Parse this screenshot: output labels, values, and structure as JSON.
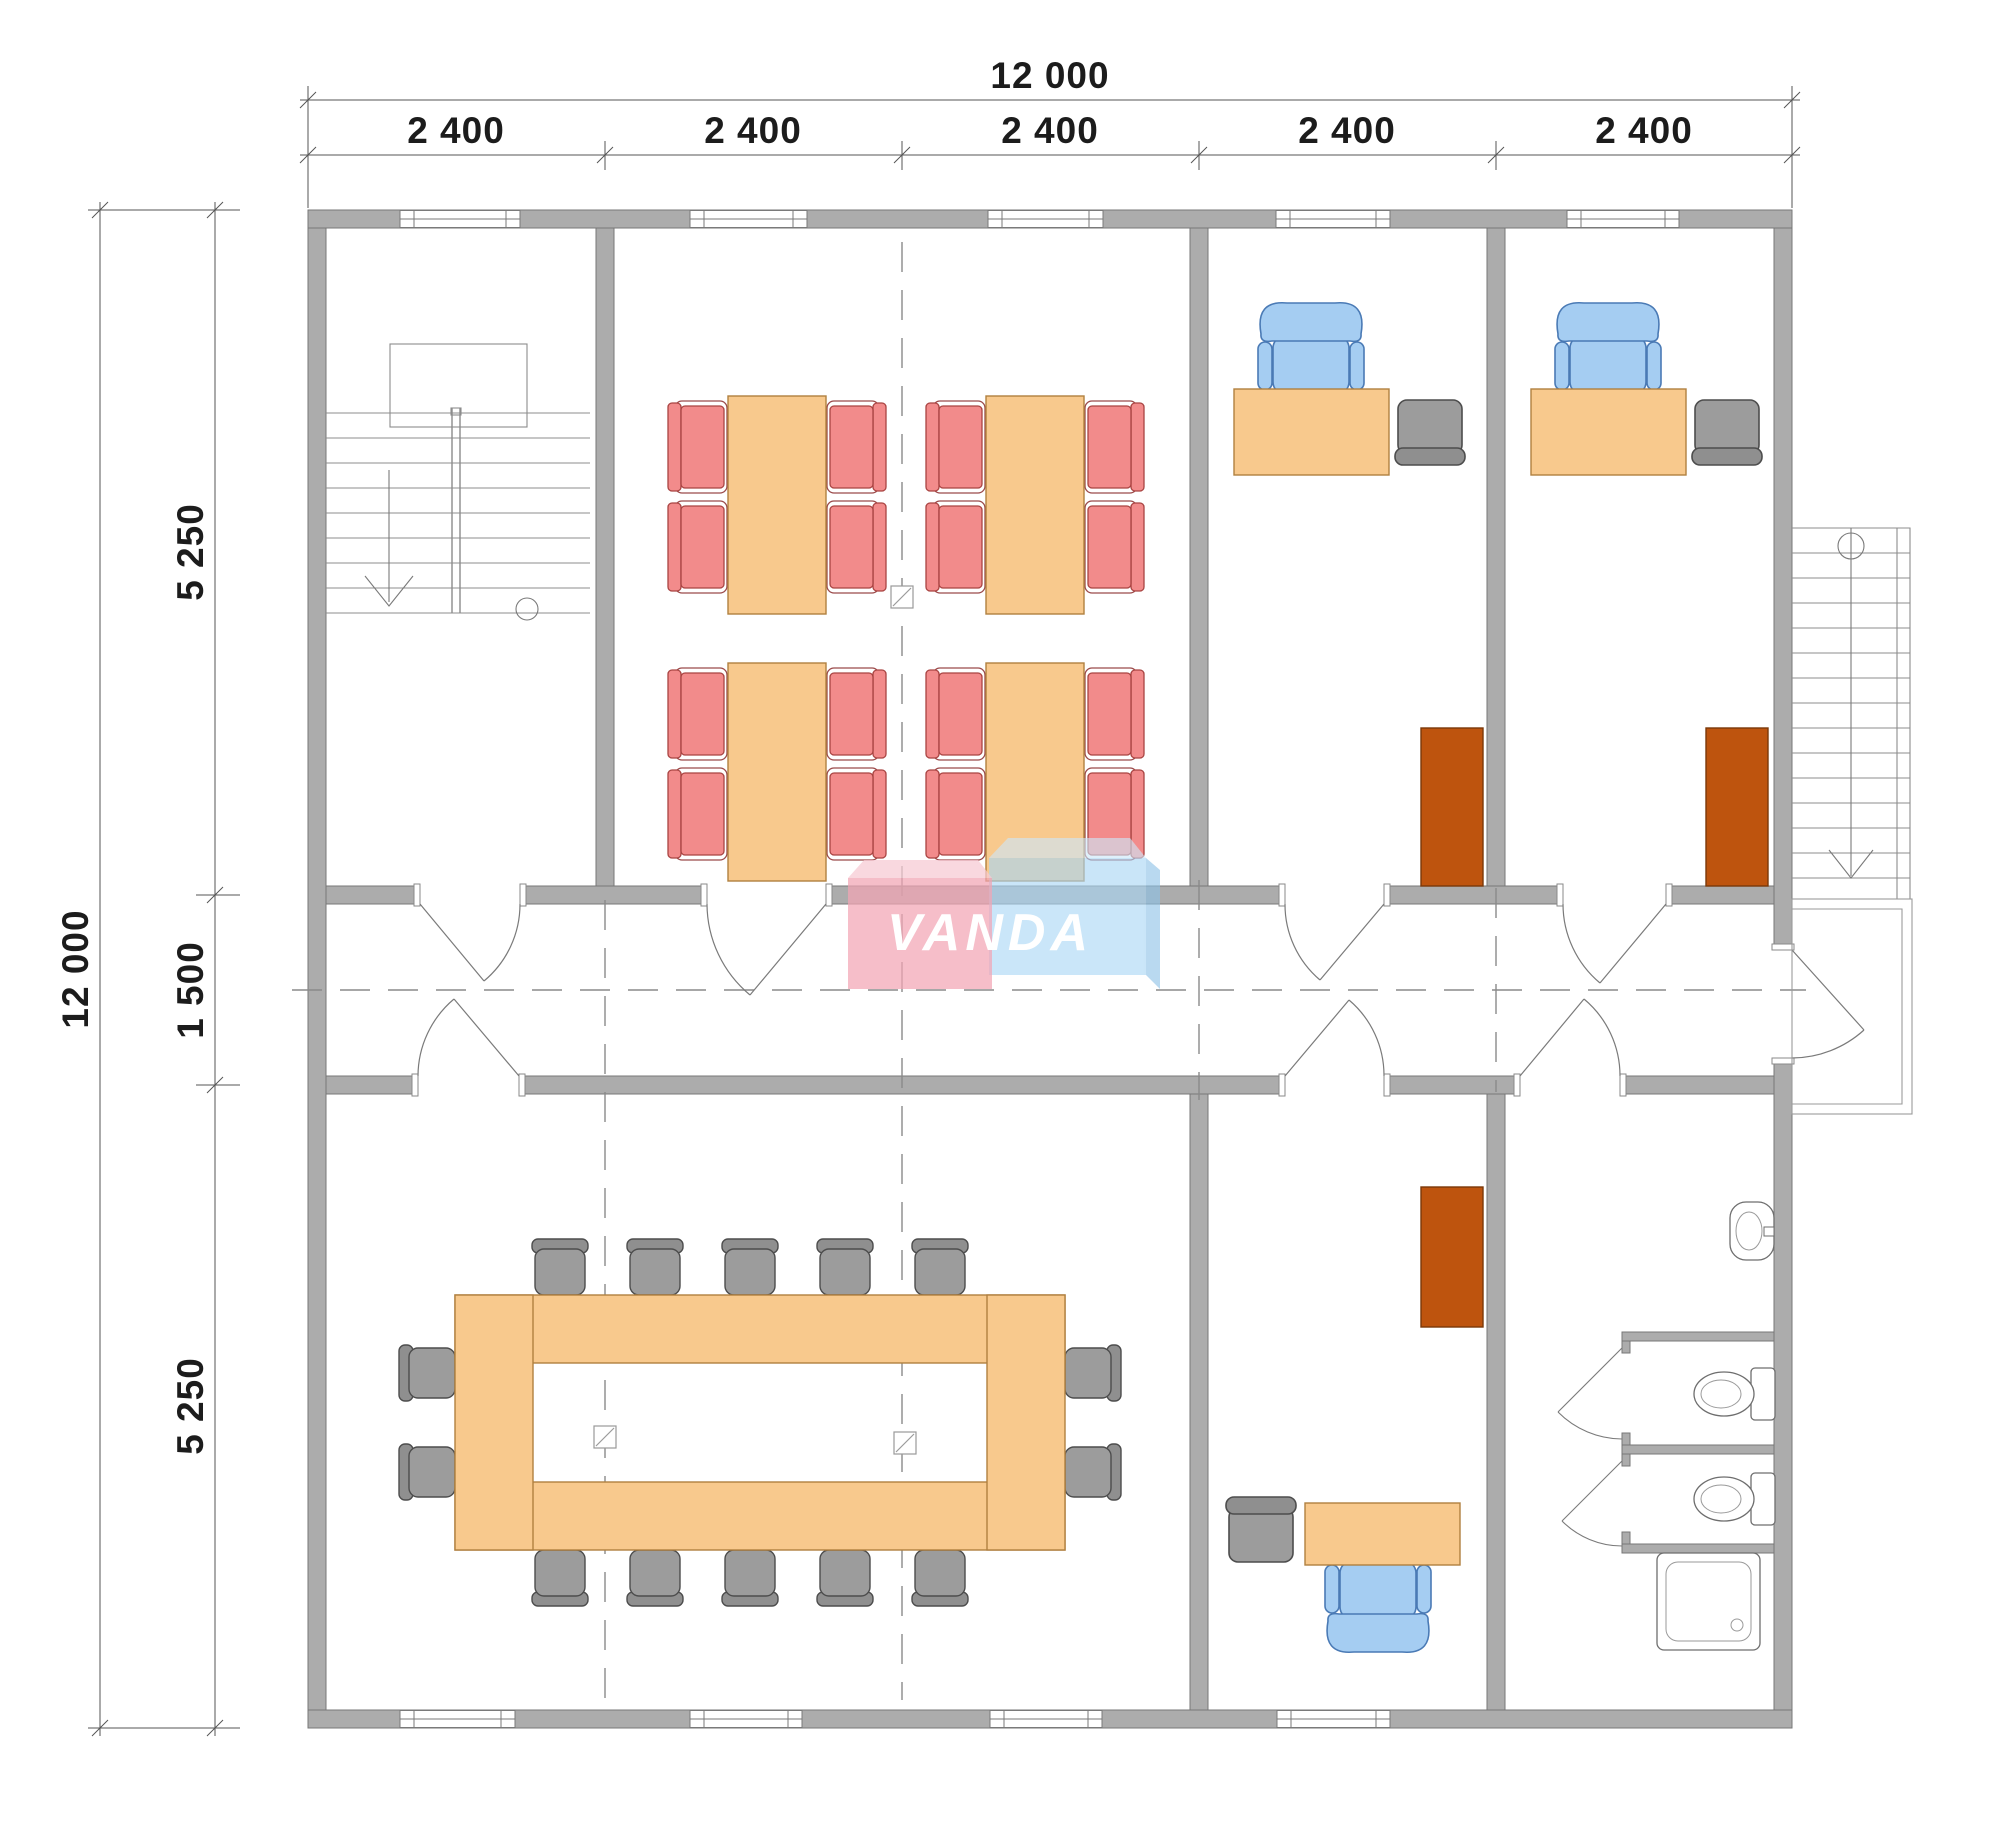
{
  "dimensions": {
    "top": {
      "overall": "12 000",
      "segments": [
        "2 400",
        "2 400",
        "2 400",
        "2 400",
        "2 400"
      ]
    },
    "left": {
      "overall": "12 000",
      "segments": [
        "5 250",
        "1 500",
        "5 250"
      ]
    }
  },
  "watermark": {
    "text": "VANDA",
    "pink_box_color": "#F2A5B4",
    "blue_box_color": "#A9D6F5"
  },
  "colors": {
    "wall": "#ACACAC",
    "wall_outline": "#777777",
    "wood_furniture": "#F8C98D",
    "chair_red": "#F28B8B",
    "chair_blue": "#A5CDF2",
    "chair_gray": "#9C9C9C",
    "cabinet_brown": "#BE540E",
    "thin_line": "#777777"
  },
  "plan_contents": {
    "rooms": [
      {
        "name": "internal-stairwell",
        "items": [
          "u-stair-down-arrow",
          "landing",
          "window"
        ]
      },
      {
        "name": "seating-room",
        "items": [
          "4 tables",
          "16 red chairs",
          "column-marker",
          "window",
          "window"
        ]
      },
      {
        "name": "office-top-1",
        "items": [
          "desk",
          "blue-office-chair",
          "gray-visitor-chair",
          "brown-cabinet",
          "window"
        ]
      },
      {
        "name": "office-top-2",
        "items": [
          "desk",
          "blue-office-chair",
          "gray-visitor-chair",
          "brown-cabinet",
          "window"
        ]
      },
      {
        "name": "corridor",
        "items": [
          "7 doors",
          "exterior-door",
          "dashed-centerline"
        ]
      },
      {
        "name": "meeting-room",
        "items": [
          "ring-conference-table",
          "14 gray chairs",
          "2 column-markers",
          "3 windows"
        ]
      },
      {
        "name": "office-bottom",
        "items": [
          "desk",
          "blue-office-chair",
          "gray-visitor-chair",
          "brown-cabinet",
          "window"
        ]
      },
      {
        "name": "bathroom",
        "items": [
          "sink",
          "2 toilets",
          "2 stall-doors",
          "shower-tray"
        ]
      },
      {
        "name": "exterior-staircase",
        "items": [
          "stair-down-arrow",
          "landing"
        ]
      }
    ]
  }
}
